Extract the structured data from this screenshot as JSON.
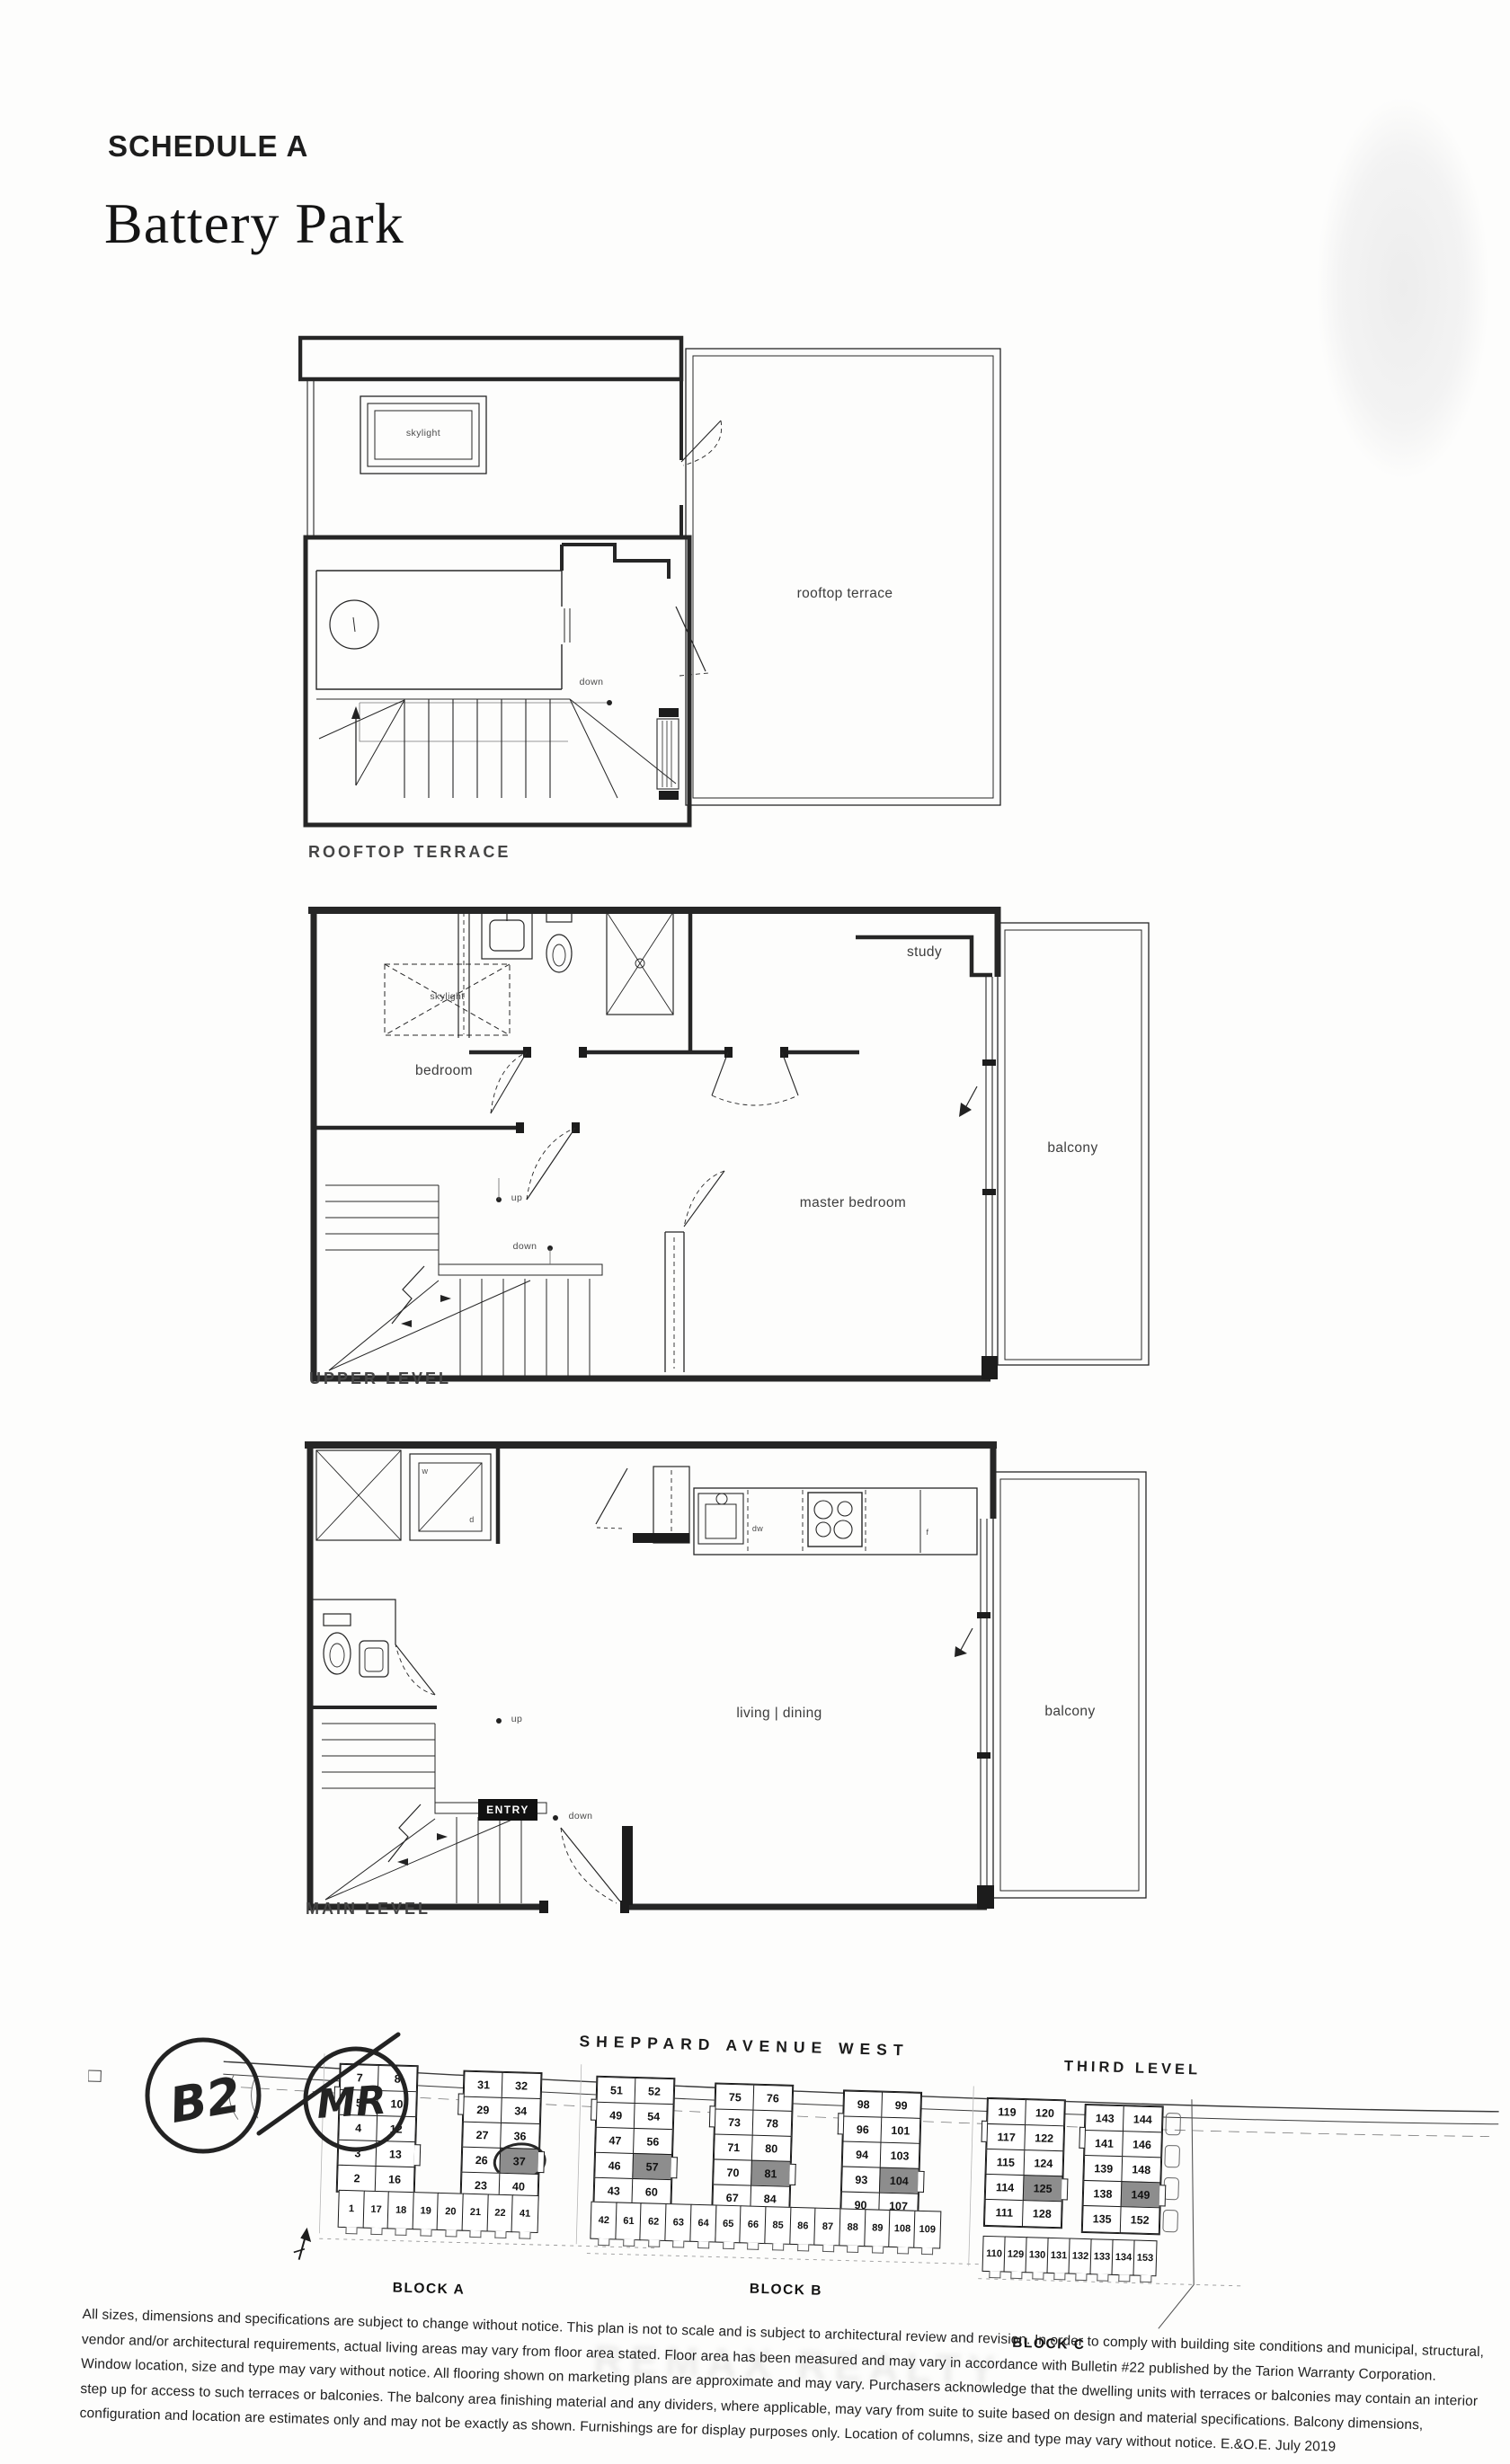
{
  "header": {
    "schedule": "SCHEDULE A",
    "project": "Battery Park"
  },
  "plans": {
    "rooftop": {
      "caption": "ROOFTOP TERRACE",
      "labels": {
        "skylight": "skylight",
        "terrace": "rooftop terrace",
        "down": "down"
      }
    },
    "upper": {
      "caption": "UPPER LEVEL",
      "labels": {
        "skylight": "skylight",
        "bedroom": "bedroom",
        "study": "study",
        "master": "master bedroom",
        "balcony": "balcony",
        "up": "up",
        "down": "down"
      }
    },
    "main": {
      "caption": "MAIN LEVEL",
      "labels": {
        "living": "living | dining",
        "balcony": "balcony",
        "entry": "ENTRY",
        "up": "up",
        "down": "down",
        "dw": "dw",
        "fridge": "f",
        "washer": "w",
        "dryer": "d"
      }
    }
  },
  "site": {
    "street": "SHEPPARD AVENUE WEST",
    "level_note": "THIRD LEVEL",
    "handwriting": {
      "left": "B2",
      "right": "MR"
    },
    "blocks": [
      {
        "label": "BLOCK A",
        "buildings": [
          {
            "rows": [
              [
                "7",
                "8"
              ],
              [
                "5",
                "10"
              ],
              [
                "4",
                "12"
              ],
              [
                "3",
                "13"
              ],
              [
                "2",
                "16"
              ]
            ]
          },
          {
            "rows": [
              [
                "31",
                "32"
              ],
              [
                "29",
                "34"
              ],
              [
                "27",
                "36"
              ],
              [
                "26",
                "37"
              ],
              [
                "23",
                "40"
              ]
            ],
            "highlight": "37",
            "scribble": "37"
          }
        ],
        "bottom": [
          "1",
          "17",
          "18",
          "19",
          "20",
          "21",
          "22",
          "41"
        ]
      },
      {
        "label": "BLOCK B",
        "buildings": [
          {
            "rows": [
              [
                "51",
                "52"
              ],
              [
                "49",
                "54"
              ],
              [
                "47",
                "56"
              ],
              [
                "46",
                "57"
              ],
              [
                "43",
                "60"
              ]
            ],
            "highlight": "57"
          },
          {
            "rows": [
              [
                "75",
                "76"
              ],
              [
                "73",
                "78"
              ],
              [
                "71",
                "80"
              ],
              [
                "70",
                "81"
              ],
              [
                "67",
                "84"
              ]
            ],
            "highlight": "81"
          },
          {
            "rows": [
              [
                "98",
                "99"
              ],
              [
                "96",
                "101"
              ],
              [
                "94",
                "103"
              ],
              [
                "93",
                "104"
              ],
              [
                "90",
                "107"
              ]
            ],
            "highlight": "104"
          }
        ],
        "bottom": [
          "42",
          "61",
          "62",
          "63",
          "64",
          "65",
          "66",
          "85",
          "86",
          "87",
          "88",
          "89",
          "108",
          "109"
        ]
      },
      {
        "label": "BLOCK C",
        "buildings": [
          {
            "rows": [
              [
                "119",
                "120"
              ],
              [
                "117",
                "122"
              ],
              [
                "115",
                "124"
              ],
              [
                "114",
                "125"
              ],
              [
                "111",
                "128"
              ]
            ],
            "highlight": "125"
          },
          {
            "rows": [
              [
                "143",
                "144"
              ],
              [
                "141",
                "146"
              ],
              [
                "139",
                "148"
              ],
              [
                "138",
                "149"
              ],
              [
                "135",
                "152"
              ]
            ],
            "highlight": "149"
          }
        ],
        "bottom": [
          "110",
          "129",
          "130",
          "131",
          "132",
          "133",
          "134",
          "153"
        ]
      }
    ]
  },
  "watermark": "REMAX REALTY",
  "disclaimer": {
    "lines": [
      "All sizes, dimensions and specifications are subject to change without notice. This plan is not to scale and is subject to architectural review and revision. In order to comply with building site conditions and municipal, structural,",
      "vendor and/or architectural requirements, actual living areas may vary from floor area stated. Floor area has been measured and may vary in accordance with Bulletin #22 published by the Tarion Warranty Corporation.",
      "Window location, size and type may vary without notice. All flooring shown on marketing plans are approximate and may vary. Purchasers acknowledge that the dwelling units with terraces or balconies may contain an interior",
      "step up for access to such terraces or balconies. The balcony area finishing material and any dividers, where applicable, may vary from suite to suite based on design and material specifications. Balcony dimensions,",
      "configuration and location are estimates only and may not be exactly as shown. Furnishings are for display purposes only. Location of columns, size and type may vary without notice. E.&O.E. July 2019"
    ]
  },
  "colors": {
    "ink": "#1f1f1f",
    "highlight": "#8d8d8d"
  }
}
